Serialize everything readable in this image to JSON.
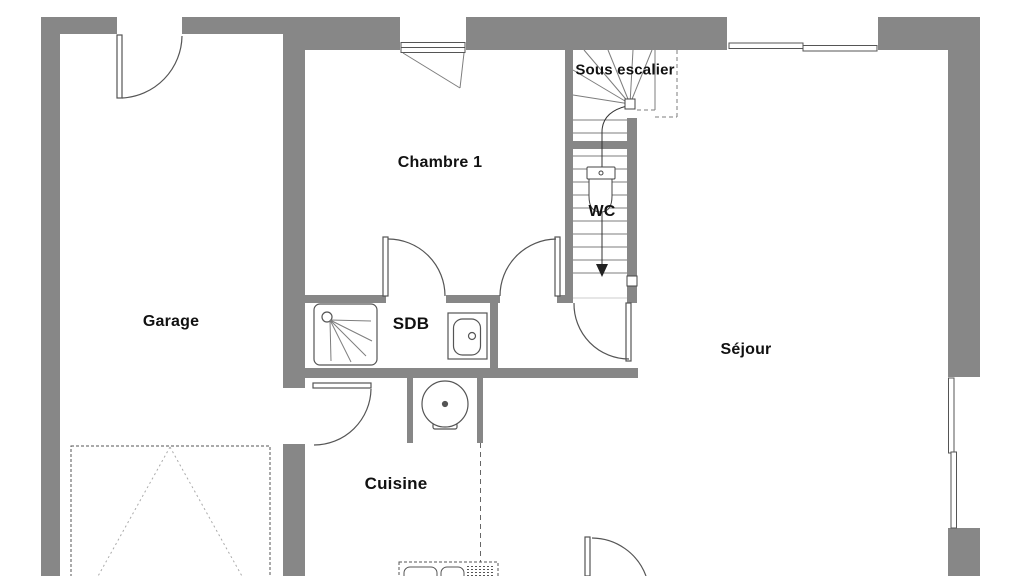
{
  "document": {
    "type": "floor-plan",
    "floor": "rez-de-chaussée"
  },
  "labels": {
    "garage": "Garage",
    "chambre1": "Chambre 1",
    "sdb": "SDB",
    "wc": "WC",
    "sous_escalier": "Sous escalier",
    "cuisine": "Cuisine",
    "sejour": "Séjour"
  },
  "colors": {
    "wall": "#878787",
    "line": "#555555",
    "text": "#111111",
    "background": "#ffffff"
  }
}
